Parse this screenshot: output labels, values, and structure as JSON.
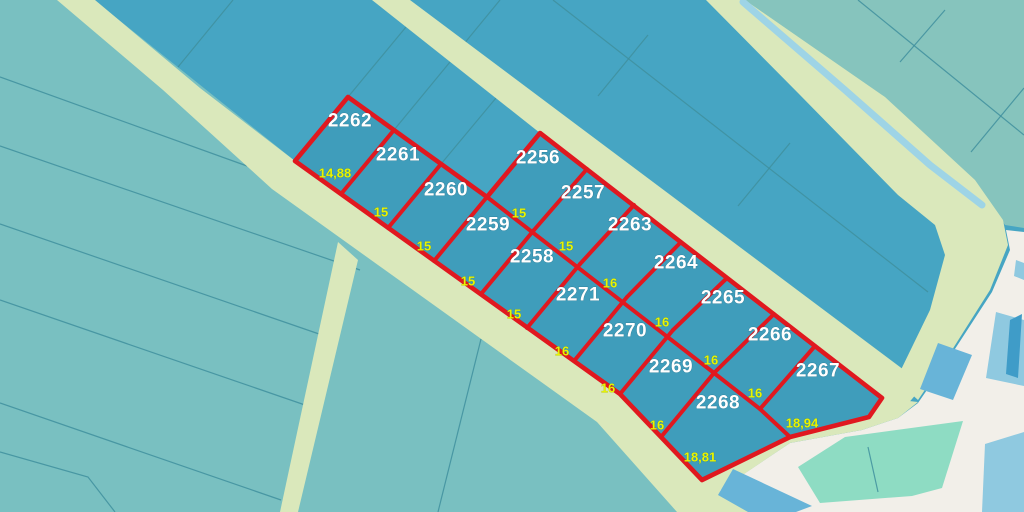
{
  "map": {
    "colors": {
      "terrain_left": "#79c0c1",
      "terrain_mid": "#46a5c3",
      "terrain_right": "#86c4bd",
      "block_fill": "#3f9dbb",
      "road": "#dae8bb",
      "red_boundary": "#e0181f",
      "thin_line": "#3f8f9d",
      "white_area": "#f2efe9",
      "mint": "#8edcc3",
      "blue_light": "#8fc9e0",
      "blue_mid": "#68b4d8",
      "blue_dark": "#3f9cc8",
      "stream": "#9ed4e6",
      "label_white": "#ffffff",
      "label_yellow": "#e8f400"
    },
    "parcel_labels": [
      {
        "text": "2262",
        "x": 350,
        "y": 121
      },
      {
        "text": "2261",
        "x": 398,
        "y": 155
      },
      {
        "text": "2260",
        "x": 446,
        "y": 190
      },
      {
        "text": "2259",
        "x": 488,
        "y": 225
      },
      {
        "text": "2258",
        "x": 532,
        "y": 257
      },
      {
        "text": "2271",
        "x": 578,
        "y": 295
      },
      {
        "text": "2270",
        "x": 625,
        "y": 331
      },
      {
        "text": "2269",
        "x": 671,
        "y": 367
      },
      {
        "text": "2268",
        "x": 718,
        "y": 403
      },
      {
        "text": "2256",
        "x": 538,
        "y": 158
      },
      {
        "text": "2257",
        "x": 583,
        "y": 193
      },
      {
        "text": "2263",
        "x": 630,
        "y": 225
      },
      {
        "text": "2264",
        "x": 676,
        "y": 263
      },
      {
        "text": "2265",
        "x": 723,
        "y": 298
      },
      {
        "text": "2266",
        "x": 770,
        "y": 335
      },
      {
        "text": "2267",
        "x": 818,
        "y": 371
      }
    ],
    "dimension_labels": [
      {
        "text": "14,88",
        "x": 335,
        "y": 173
      },
      {
        "text": "15",
        "x": 381,
        "y": 212
      },
      {
        "text": "15",
        "x": 424,
        "y": 246
      },
      {
        "text": "15",
        "x": 468,
        "y": 281
      },
      {
        "text": "15",
        "x": 514,
        "y": 314
      },
      {
        "text": "16",
        "x": 562,
        "y": 351
      },
      {
        "text": "16",
        "x": 608,
        "y": 388
      },
      {
        "text": "16",
        "x": 657,
        "y": 425
      },
      {
        "text": "18,81",
        "x": 700,
        "y": 457
      },
      {
        "text": "18,94",
        "x": 802,
        "y": 423
      },
      {
        "text": "15",
        "x": 519,
        "y": 213
      },
      {
        "text": "15",
        "x": 566,
        "y": 246
      },
      {
        "text": "16",
        "x": 610,
        "y": 283
      },
      {
        "text": "16",
        "x": 662,
        "y": 322
      },
      {
        "text": "16",
        "x": 711,
        "y": 360
      },
      {
        "text": "16",
        "x": 755,
        "y": 393
      }
    ]
  }
}
